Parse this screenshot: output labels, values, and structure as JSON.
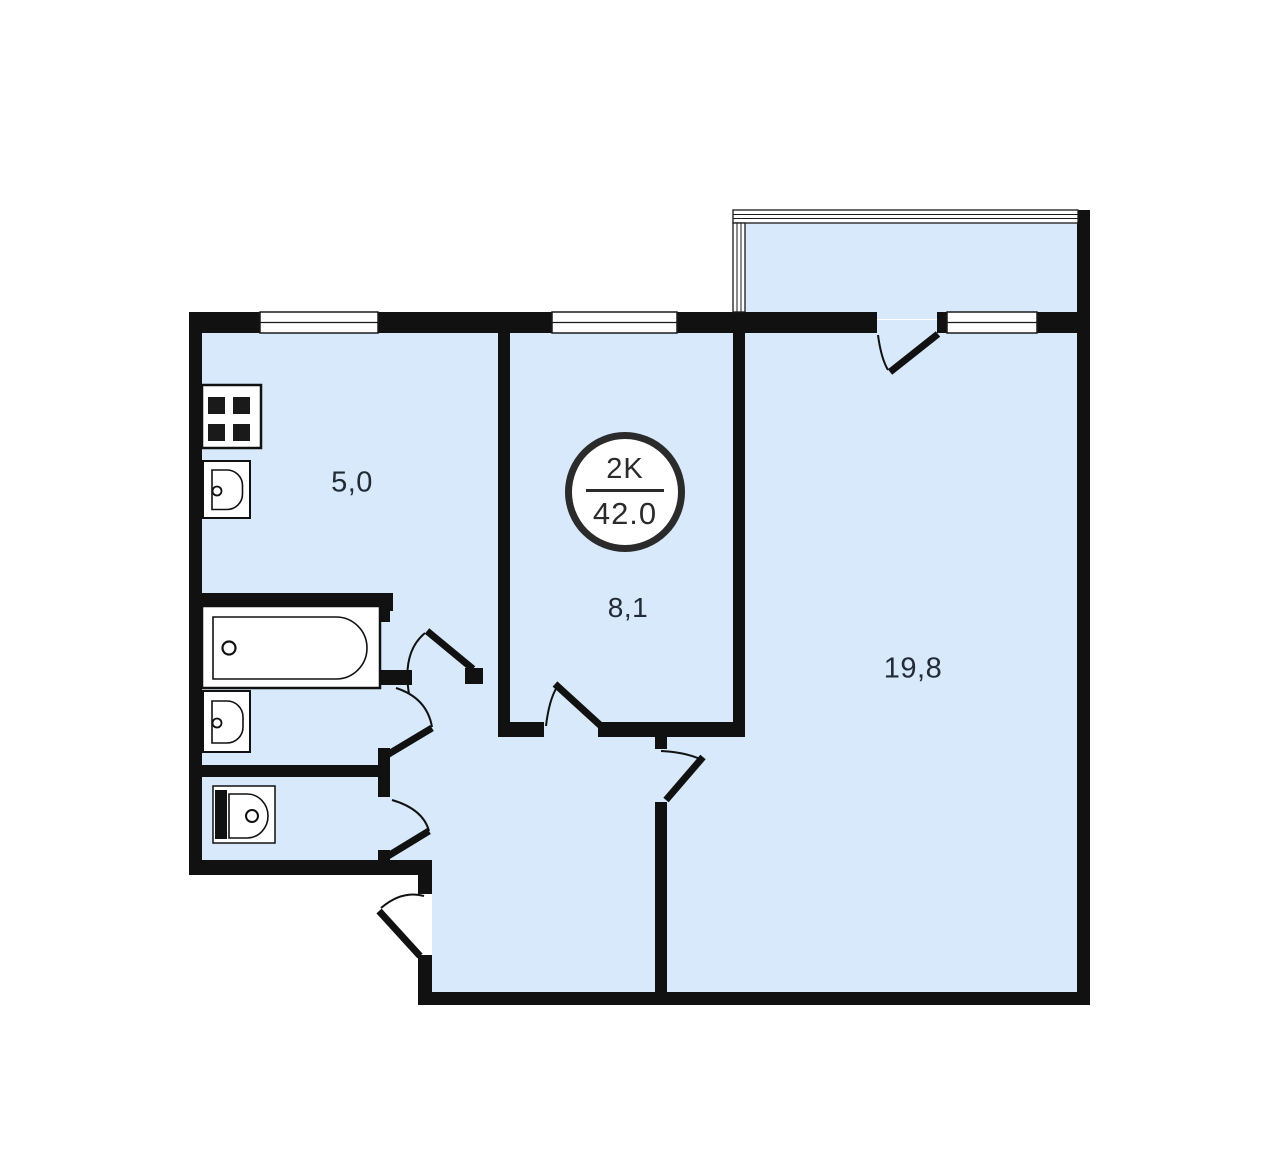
{
  "floor_plan": {
    "badge": {
      "rooms_label": "2K",
      "area_value": "42.0"
    },
    "rooms": [
      {
        "id": "kitchen",
        "area": "5,0"
      },
      {
        "id": "room-8-1",
        "area": "8,1"
      },
      {
        "id": "room-19-8",
        "area": "19,8"
      }
    ],
    "fixtures": [
      "stove",
      "kitchen-sink",
      "bathtub",
      "wash-basin",
      "toilet"
    ],
    "colors": {
      "floor": "#d7e9fb",
      "wall": "#111111",
      "text": "#222b35",
      "badge_border": "#2b2b2b",
      "fixture_fill": "#ffffff"
    }
  }
}
